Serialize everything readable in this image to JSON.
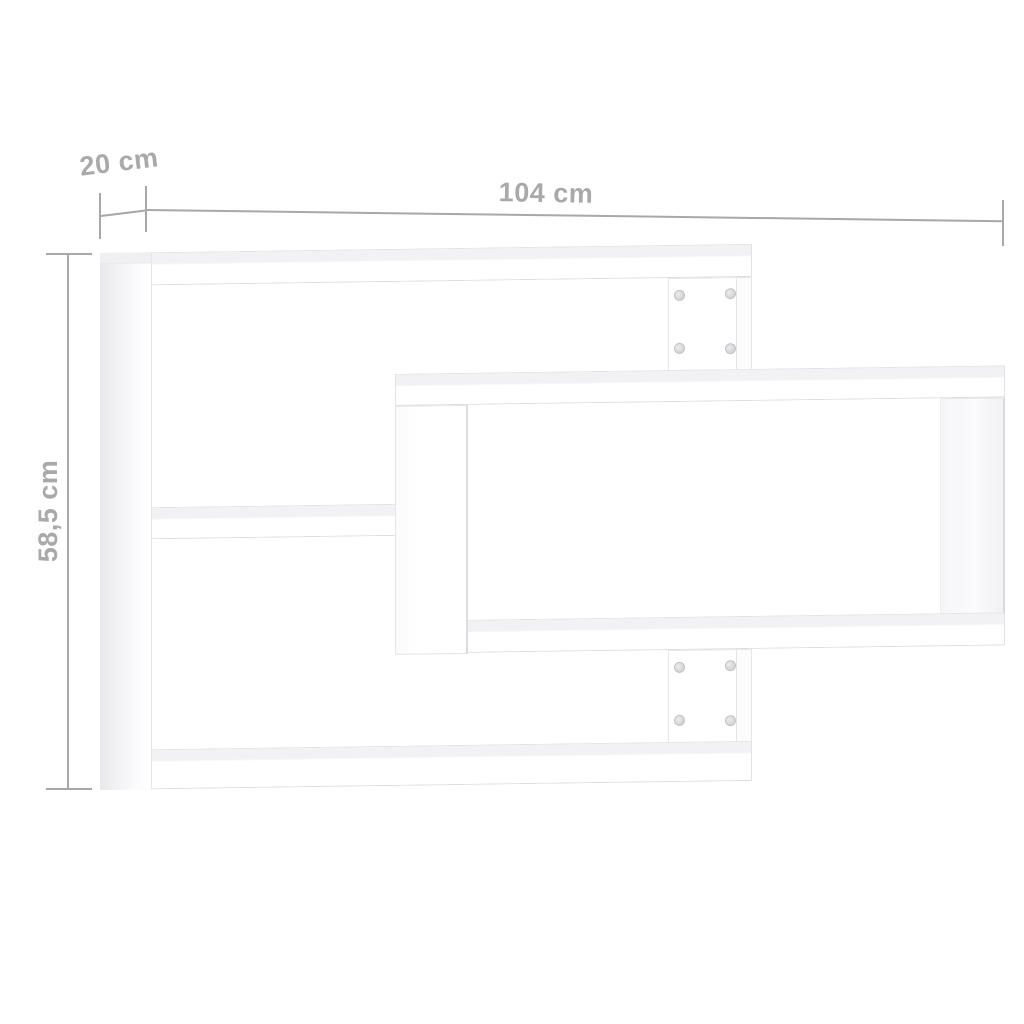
{
  "diagram": {
    "subject": "cascading-wall-shelves",
    "unit": "cm",
    "dimensions": {
      "depth": {
        "label": "20 cm",
        "value_cm": 20
      },
      "width": {
        "label": "104 cm",
        "value_cm": 104
      },
      "height": {
        "label": "58,5 cm",
        "value_cm": 58.5
      }
    },
    "screws": {
      "count": 8,
      "icon": "screw-cam-mark"
    },
    "colors": {
      "background": "#ffffff",
      "dimension_text": "#a9a9a9",
      "dimension_line": "#a8a8a8",
      "board_fill": "#ffffff",
      "board_edge": "#e2e2e4",
      "board_top_face": "#f2f2f4",
      "left_panel_shade": "#e9e9eb",
      "screw_ring": "#c2c2c4"
    }
  }
}
